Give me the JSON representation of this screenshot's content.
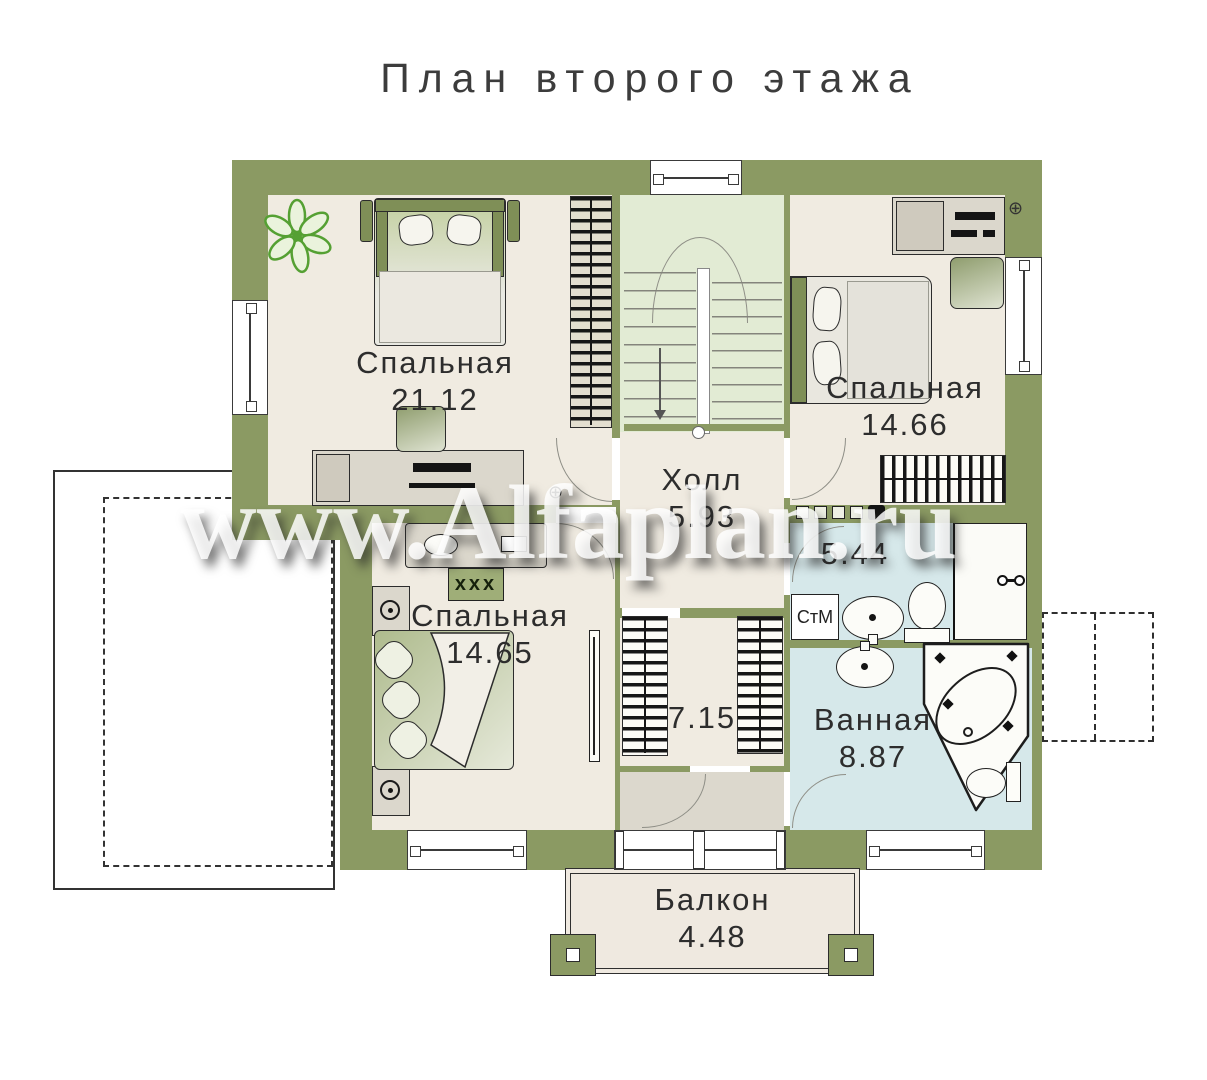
{
  "title": "План второго этажа",
  "watermark": "www.Alfaplan.ru",
  "rooms": {
    "bedroom_top_left": {
      "name": "Спальная",
      "area": "21.12"
    },
    "bedroom_top_right": {
      "name": "Спальная",
      "area": "14.66"
    },
    "bedroom_bottom_left": {
      "name": "Спальная",
      "area": "14.65"
    },
    "hall": {
      "name": "Холл",
      "area": "5.93"
    },
    "wc": {
      "area": "5.44"
    },
    "wardrobe": {
      "area": "7.15"
    },
    "bathroom": {
      "name": "Ванная",
      "area": "8.87"
    },
    "balcony": {
      "name": "Балкон",
      "area": "4.48"
    }
  },
  "labels": {
    "washing_machine": "СтМ",
    "chest": "xxx"
  },
  "colors": {
    "wall": "#8b9a63",
    "room_floor": "#f0ebe1",
    "stair_floor": "#e2ebd4",
    "bath_floor": "#d6e8ea",
    "furniture": "#dbd7cc",
    "plant": "#5ca03c"
  }
}
